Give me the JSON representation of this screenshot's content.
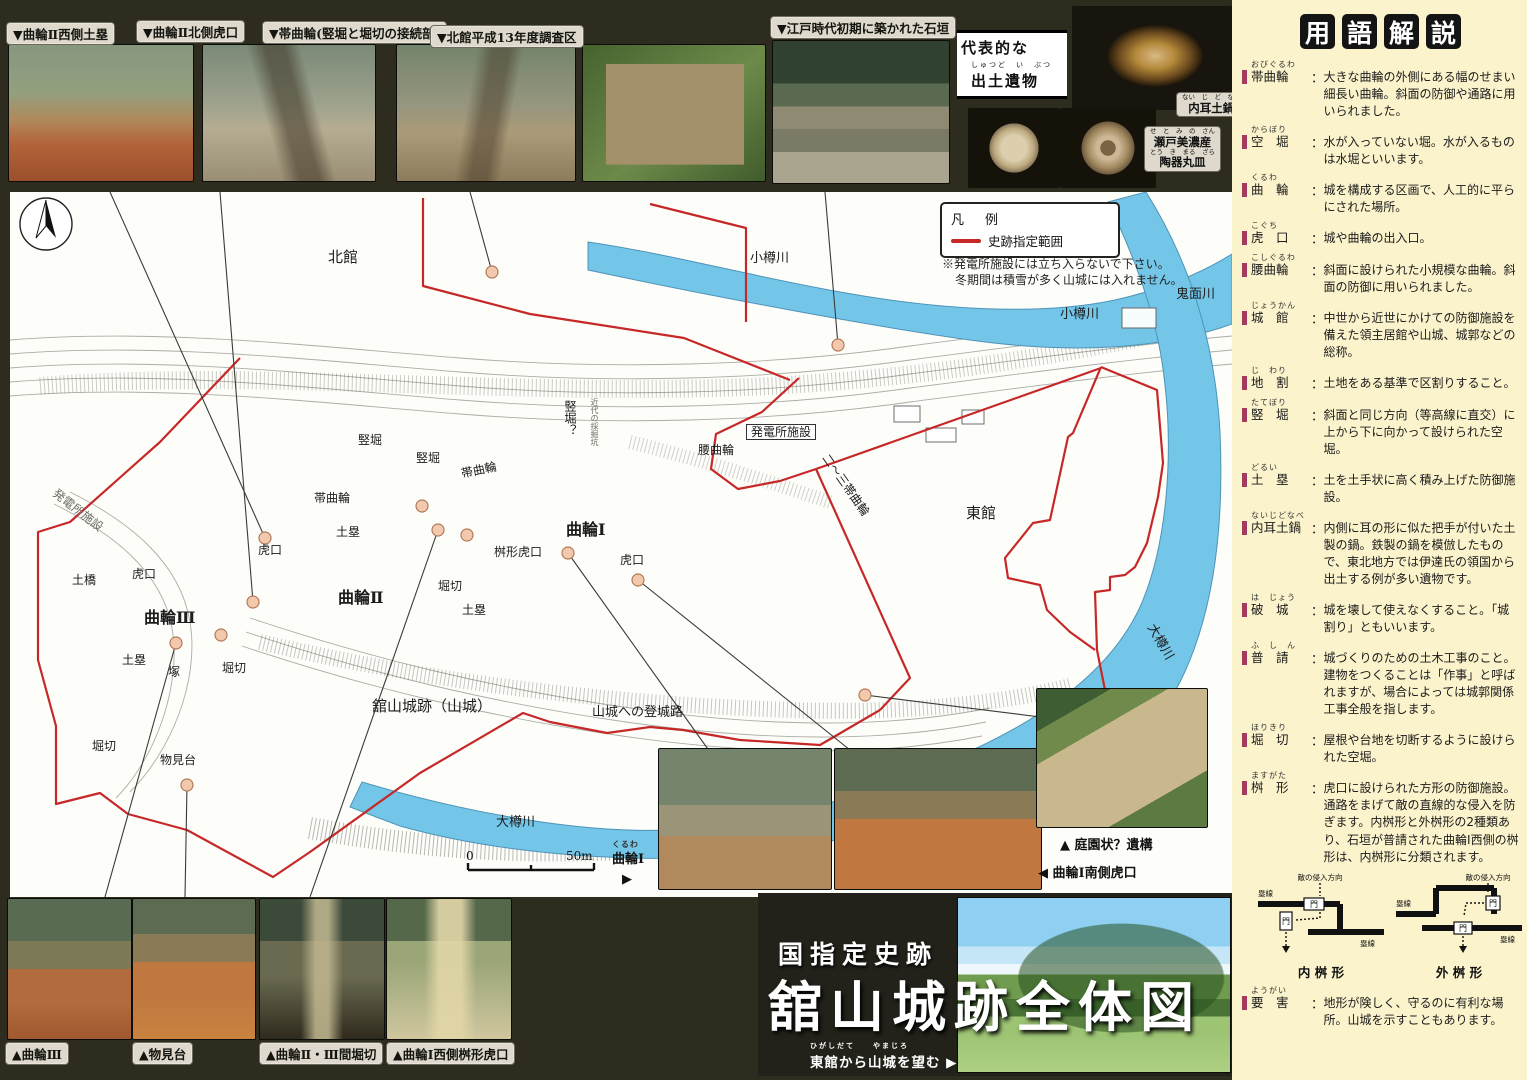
{
  "colors": {
    "frame": "#2e2c1e",
    "sidebar_bg": "#fbf3cc",
    "water": "#74c6e8",
    "boundary_red": "#c62828",
    "bullet_bar": "#a43b5e"
  },
  "top_photos": [
    {
      "caption": "▼曲輪Ⅱ西側土塁"
    },
    {
      "caption": "▼曲輪Ⅱ北側虎口"
    },
    {
      "caption": "▼帯曲輪(竪堀と堀切の接続部)"
    },
    {
      "caption": "▼北館平成13年度調査区"
    },
    {
      "caption": "▼江戸時代初期に築かれた石垣"
    }
  ],
  "artifacts": {
    "heading_line1": "代表的な",
    "heading_furigana": "しゅつど　い　ぶつ",
    "heading_line2": "出土遺物",
    "label1": {
      "furigana": "ない　じ　ど　なべ",
      "text": "内耳土鍋"
    },
    "label2": {
      "furigana1": "せ　と　み　の　さん",
      "line1": "瀬戸美濃産",
      "furigana2": "とう　き　まる　ざら",
      "line2": "陶器丸皿"
    }
  },
  "legend": {
    "title": "凡　例",
    "item": "史跡指定範囲",
    "note1": "※発電所施設には立ち入らないで下さい。",
    "note2": "冬期間は積雪が多く山城には入れません。"
  },
  "map": {
    "scale_zero": "0",
    "scale_fifty": "50m",
    "labels": [
      {
        "text": "北館"
      },
      {
        "text": "小樽川"
      },
      {
        "text": "鬼面川"
      },
      {
        "text": "小樽川"
      },
      {
        "text": "竪堀"
      },
      {
        "text": "竪堀"
      },
      {
        "text": "竪堀？"
      },
      {
        "text": "近代の採掘坑"
      },
      {
        "text": "帯曲輪"
      },
      {
        "text": "帯曲輪"
      },
      {
        "text": "発電所施設"
      },
      {
        "text": "発電所施設"
      },
      {
        "text": "腰曲輪"
      },
      {
        "text": "土塁"
      },
      {
        "text": "虎口"
      },
      {
        "text": "虎口"
      },
      {
        "text": "土橋"
      },
      {
        "text": "曲輪Ⅲ"
      },
      {
        "text": "曲輪Ⅱ"
      },
      {
        "text": "曲輪Ⅰ"
      },
      {
        "text": "虎口"
      },
      {
        "text": "桝形虎口"
      },
      {
        "text": "堀切"
      },
      {
        "text": "土塁"
      },
      {
        "text": "土塁"
      },
      {
        "text": "塚"
      },
      {
        "text": "堀切"
      },
      {
        "text": "堀切"
      },
      {
        "text": "物見台"
      },
      {
        "text": "東館"
      },
      {
        "text": "二～三帯曲輪"
      },
      {
        "text": "大樽川"
      },
      {
        "text": "大樽川"
      },
      {
        "text": "舘山城跡（山城）"
      },
      {
        "text": "山城への登城路"
      }
    ],
    "inset": {
      "garden_caption": "▲ 庭園状？遺構",
      "south_gate_caption": "◀ 曲輪Ⅰ南側虎口",
      "kuruwa1_furigana": "くるわ",
      "kuruwa1": "曲輪Ⅰ",
      "pointer": "▶"
    }
  },
  "bottom_photos": [
    {
      "caption": "▲曲輪Ⅲ"
    },
    {
      "caption": "▲物見台"
    },
    {
      "caption": "▲曲輪Ⅱ・Ⅲ間堀切"
    },
    {
      "caption": "▲曲輪Ⅰ西側桝形虎口"
    }
  ],
  "title_block": {
    "kanmuri": "国指定史跡",
    "main": "舘山城跡全体図",
    "caption_furigana": "ひがしだて　　やまじろ",
    "caption": "東館から山城を望む",
    "pointer": "▶"
  },
  "glossary": {
    "heading": [
      "用",
      "語",
      "解",
      "説"
    ],
    "colon": "：",
    "entries": [
      {
        "furigana": "おびぐるわ",
        "term": "帯曲輪",
        "def": "大きな曲輪の外側にある幅のせまい細長い曲輪。斜面の防御や通路に用いられました。"
      },
      {
        "furigana": "からぼり",
        "term": "空　堀",
        "def": "水が入っていない堀。水が入るものは水堀といいます。"
      },
      {
        "furigana": "くるわ",
        "term": "曲　輪",
        "def": "城を構成する区画で、人工的に平らにされた場所。"
      },
      {
        "furigana": "こぐち",
        "term": "虎　口",
        "def": "城や曲輪の出入口。"
      },
      {
        "furigana": "こしぐるわ",
        "term": "腰曲輪",
        "def": "斜面に設けられた小規模な曲輪。斜面の防御に用いられました。"
      },
      {
        "furigana": "じょうかん",
        "term": "城　館",
        "def": "中世から近世にかけての防御施設を備えた領主居館や山城、城郭などの総称。"
      },
      {
        "furigana": "じ　わり",
        "term": "地　割",
        "def": "土地をある基準で区割りすること。"
      },
      {
        "furigana": "たてぼり",
        "term": "竪　堀",
        "def": "斜面と同じ方向（等高線に直交）に上から下に向かって設けられた空堀。"
      },
      {
        "furigana": "どるい",
        "term": "土　塁",
        "def": "土を土手状に高く積み上げた防御施設。"
      },
      {
        "furigana": "ないじどなべ",
        "term": "内耳土鍋",
        "def": "内側に耳の形に似た把手が付いた土製の鍋。鉄製の鍋を模倣したもので、東北地方では伊達氏の領国から出土する例が多い遺物です。"
      },
      {
        "furigana": "は　じょう",
        "term": "破　城",
        "def": "城を壊して使えなくすること。「城割り」ともいいます。"
      },
      {
        "furigana": "ふ　し　ん",
        "term": "普　請",
        "def": "城づくりのための土木工事のこと。建物をつくることは「作事」と呼ばれますが、場合によっては城郭関係工事全般を指します。"
      },
      {
        "furigana": "ほりきり",
        "term": "堀　切",
        "def": "屋根や台地を切断するように設けられた空堀。"
      },
      {
        "furigana": "ますがた",
        "term": "桝　形",
        "def": "虎口に設けられた方形の防御施設。通路をまげて敵の直線的な侵入を防ぎます。内桝形と外桝形の2種類あり、石垣が普請された曲輪Ⅰ西側の桝形は、内桝形に分類されます。"
      },
      {
        "furigana": "ようがい",
        "term": "要　害",
        "def": "地形が険しく、守るのに有利な場所。山城を示すこともあります。"
      }
    ],
    "diagram": {
      "enemy": "敵の侵入方向",
      "wall": "塁線",
      "gate": "門",
      "inner_caption": "内 桝 形",
      "outer_caption": "外 桝 形"
    }
  }
}
